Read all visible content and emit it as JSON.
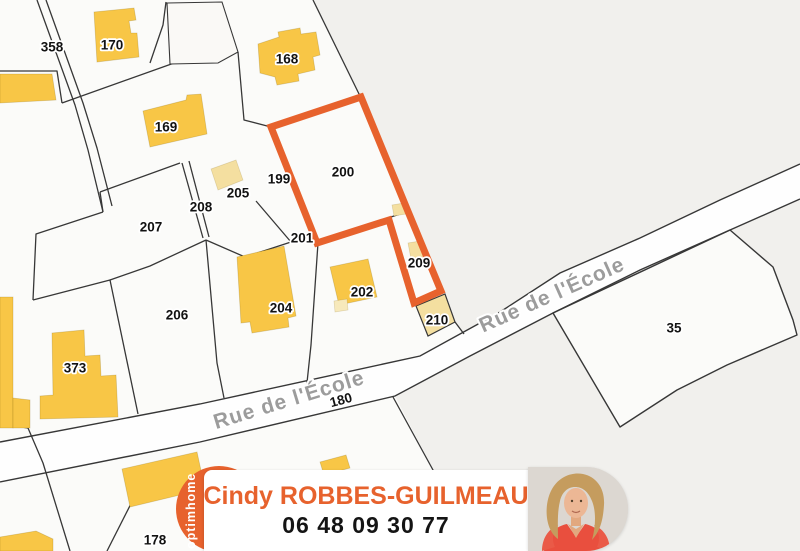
{
  "map": {
    "colors": {
      "background": "#f1f0ed",
      "parcel_fill": "#fbfbf9",
      "road_fill": "#fefefe",
      "boundary_line": "#373737",
      "building": "#f8c646",
      "building_light": "#f4dfa0",
      "highlight": "#e7622d",
      "street_text": "#9c9c9c"
    },
    "highlighted_parcel": "200",
    "parcel_labels": [
      {
        "text": "358",
        "x": 52,
        "y": 47
      },
      {
        "text": "170",
        "x": 112,
        "y": 45
      },
      {
        "text": "168",
        "x": 287,
        "y": 59
      },
      {
        "text": "169",
        "x": 166,
        "y": 127
      },
      {
        "text": "205",
        "x": 238,
        "y": 193
      },
      {
        "text": "208",
        "x": 201,
        "y": 207
      },
      {
        "text": "207",
        "x": 151,
        "y": 227
      },
      {
        "text": "199",
        "x": 279,
        "y": 179
      },
      {
        "text": "200",
        "x": 343,
        "y": 172,
        "size": 18
      },
      {
        "text": "201",
        "x": 302,
        "y": 238
      },
      {
        "text": "202",
        "x": 362,
        "y": 292
      },
      {
        "text": "209",
        "x": 419,
        "y": 263
      },
      {
        "text": "210",
        "x": 437,
        "y": 320
      },
      {
        "text": "204",
        "x": 281,
        "y": 308
      },
      {
        "text": "206",
        "x": 177,
        "y": 315
      },
      {
        "text": "373",
        "x": 75,
        "y": 368
      },
      {
        "text": "35",
        "x": 674,
        "y": 328
      },
      {
        "text": "180",
        "x": 341,
        "y": 400,
        "size": 12.5,
        "rot": -15
      },
      {
        "text": "178",
        "x": 155,
        "y": 540,
        "size": 12.5
      }
    ],
    "street_labels": [
      {
        "text": "Rue de l'École",
        "x": 552,
        "y": 295,
        "rot": -24
      },
      {
        "text": "Rue de l'École",
        "x": 289,
        "y": 400,
        "rot": -17
      }
    ]
  },
  "banner": {
    "brand": "optimhome",
    "brand_bg": "#e7622d",
    "agent_name": "Cindy ROBBES-GUILMEAU",
    "phone": "06 48 09 30 77",
    "name_color": "#e7622d",
    "phone_color": "#141414"
  }
}
